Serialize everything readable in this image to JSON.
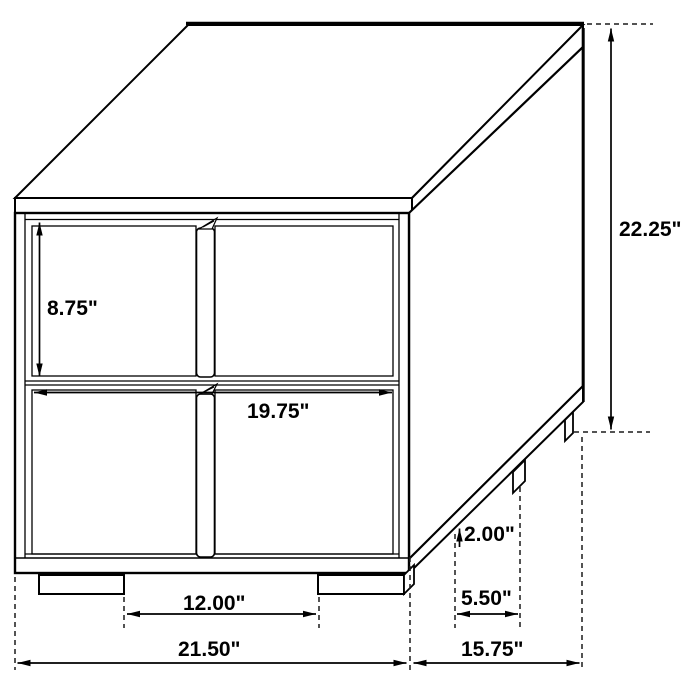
{
  "diagram": {
    "subject": "two-drawer nightstand isometric dimension drawing",
    "background_color": "#ffffff",
    "line_color": "#000000",
    "text_color": "#000000",
    "units": "inches",
    "dimensions": {
      "drawer_height": {
        "label": "8.75\"",
        "inches": 8.75,
        "measures": "drawer front height"
      },
      "interior_width": {
        "label": "19.75\"",
        "inches": 19.75,
        "measures": "inner front width"
      },
      "overall_height": {
        "label": "22.25\"",
        "inches": 22.25,
        "measures": "overall height"
      },
      "foot_height": {
        "label": "2.00\"",
        "inches": 2.0,
        "measures": "foot height"
      },
      "side_foot_gap": {
        "label": "5.50\"",
        "inches": 5.5,
        "measures": "side foot spacing"
      },
      "front_foot_gap": {
        "label": "12.00\"",
        "inches": 12.0,
        "measures": "front foot spacing"
      },
      "overall_width": {
        "label": "21.50\"",
        "inches": 21.5,
        "measures": "overall width"
      },
      "overall_depth": {
        "label": "15.75\"",
        "inches": 15.75,
        "measures": "overall depth"
      }
    }
  }
}
